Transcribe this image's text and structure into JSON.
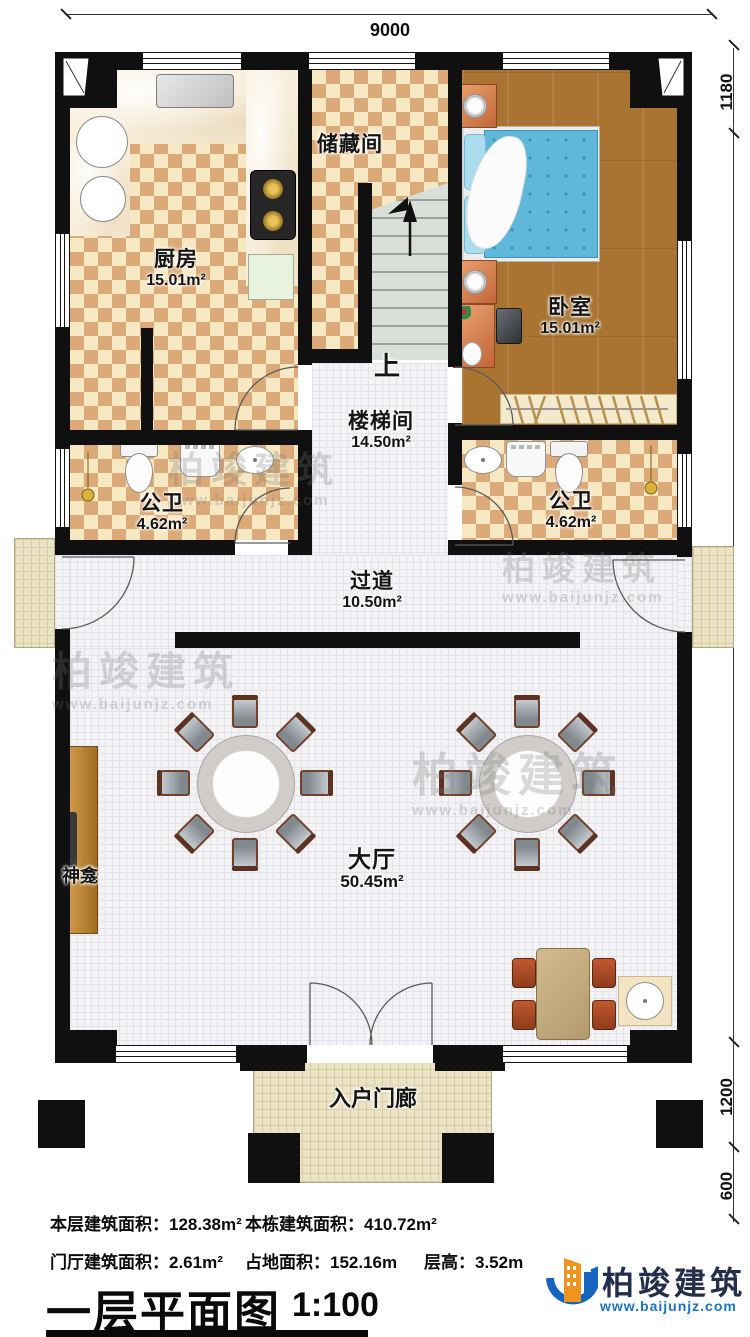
{
  "dimensions": {
    "top": "9000",
    "right_top": "1180",
    "right_mid": "13800",
    "right_low": "1200",
    "right_bottom": "600"
  },
  "rooms": {
    "kitchen": {
      "name": "厨房",
      "area": "15.01m²"
    },
    "storage": {
      "name": "储藏间"
    },
    "stairwell": {
      "name": "楼梯间",
      "area": "14.50m²",
      "up_label": "上"
    },
    "bedroom": {
      "name": "卧室",
      "area": "15.01m²"
    },
    "bath_left": {
      "name": "公卫",
      "area": "4.62m²"
    },
    "bath_right": {
      "name": "公卫",
      "area": "4.62m²"
    },
    "corridor": {
      "name": "过道",
      "area": "10.50m²"
    },
    "hall": {
      "name": "大厅",
      "area": "50.45m²"
    },
    "shrine": {
      "name": "神龛"
    },
    "porch": {
      "name": "入户门廊"
    }
  },
  "stats": {
    "floor_area_label": "本层建筑面积：",
    "floor_area_value": "128.38m²",
    "building_area_label": "本栋建筑面积：",
    "building_area_value": "410.72m²",
    "foyer_area_label": "门厅建筑面积：",
    "foyer_area_value": "2.61m²",
    "land_area_label": "占地面积：",
    "land_area_value": "152.16m",
    "height_label": "层高：",
    "height_value": "3.52m"
  },
  "footer": {
    "title": "一层平面图",
    "scale": "1:100"
  },
  "brand": {
    "name": "柏竣建筑",
    "url": "www.baijunjz.com"
  },
  "watermark": {
    "text": "柏竣建筑",
    "url": "www.baijunjz.com"
  },
  "colors": {
    "wall": "#101010",
    "checker_dark": "#dcaa78",
    "wood": "#a97431",
    "brand_blue": "#1565c0",
    "brand_orange": "#f0941f",
    "brand_navy": "#222e4c"
  }
}
